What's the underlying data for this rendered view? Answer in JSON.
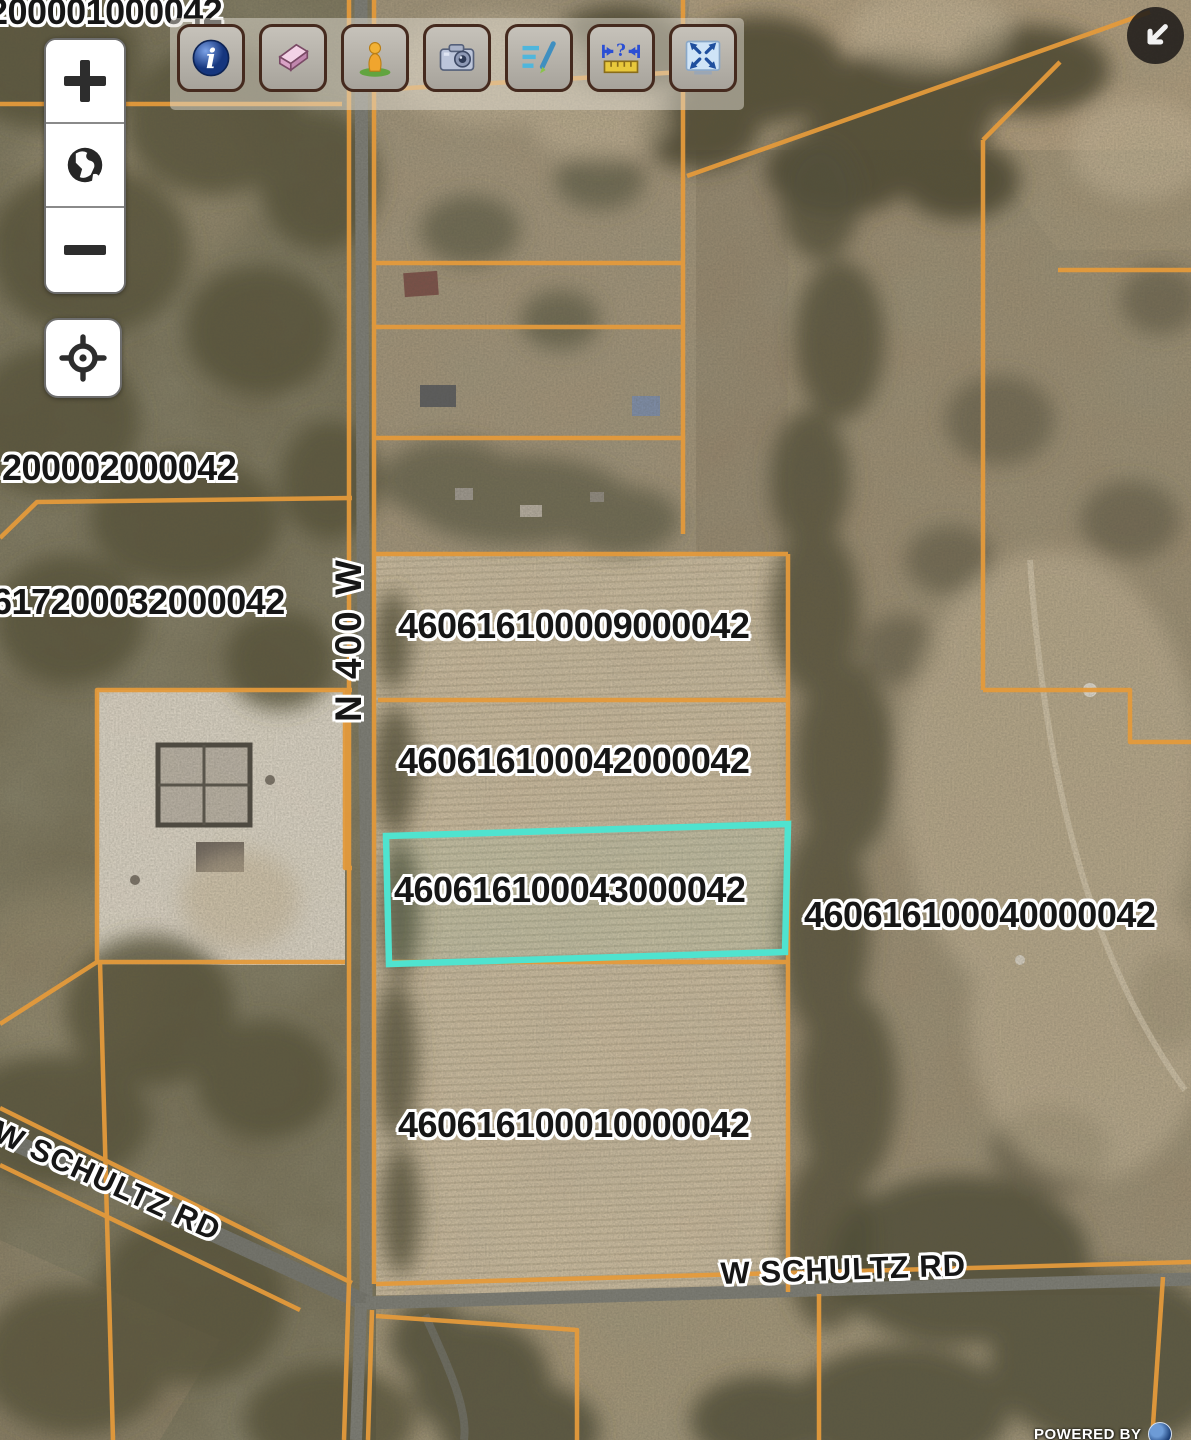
{
  "toolbar": {
    "buttons": [
      {
        "icon": "info-icon"
      },
      {
        "icon": "eraser-icon"
      },
      {
        "icon": "person-icon"
      },
      {
        "icon": "camera-icon"
      },
      {
        "icon": "sketch-icon"
      },
      {
        "icon": "measure-icon"
      },
      {
        "icon": "extent-icon"
      }
    ]
  },
  "map_controls": {
    "zoom_in_icon": "plus-icon",
    "home_icon": "globe-icon",
    "zoom_out_icon": "minus-icon",
    "locate_icon": "crosshair-icon",
    "collapse_icon": "arrow-southwest-icon"
  },
  "parcel_labels": {
    "p200001000042": "200001000042",
    "p200002000042": "200002000042",
    "p617200032000042": "617200032000042",
    "p460616100009000042": "460616100009000042",
    "p460616100042000042": "460616100042000042",
    "p460616100043000042": "460616100043000042",
    "p460616100040000042": "460616100040000042",
    "p460616100010000042": "460616100010000042"
  },
  "selected_parcel": {
    "id": "460616100043000042",
    "highlight_color": "#4FE3CF"
  },
  "road_labels": {
    "n400w": "N 400 W",
    "schultz_west": "W SCHULTZ RD",
    "schultz_east": "W SCHULTZ RD"
  },
  "attribution": {
    "text": "POWERED BY",
    "logo": "circle-logo"
  },
  "colors": {
    "parcel_line": "#E49A3B",
    "highlight": "#4FE3CF",
    "road": "#7B7B73",
    "label_text": "#161616",
    "label_halo": "#FFFFFF"
  }
}
